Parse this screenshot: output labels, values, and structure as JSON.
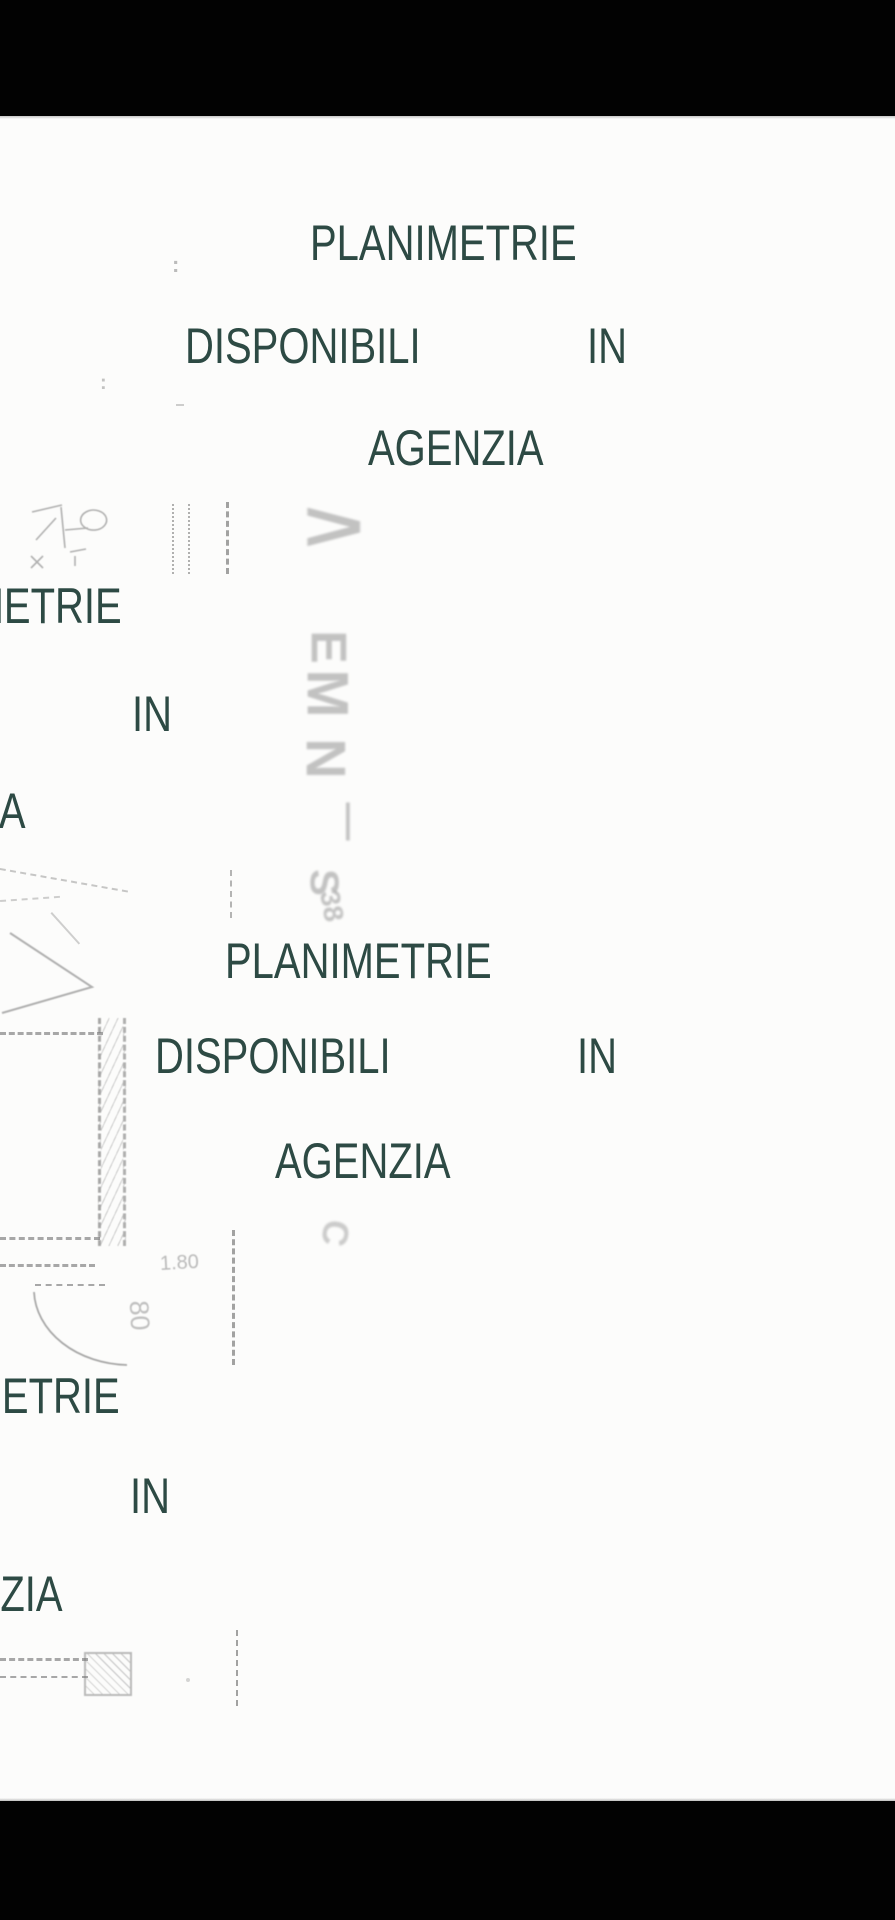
{
  "page": {
    "background": "#fcfcfb",
    "letterbox_color": "#020202",
    "watermark_color": "#2d4a44"
  },
  "watermark": {
    "word_planimetrie": "PLANIMETRIE",
    "word_disponibili": "DISPONIBILI",
    "word_in": "IN",
    "word_agenzia": "AGENZIA"
  },
  "plan": {
    "dim_width": "1.80",
    "dim_door": "80",
    "stamp_glyphs": [
      "E",
      "M",
      "N",
      "—",
      "S",
      "38"
    ],
    "arrow_glyph": ">",
    "c_glyph": "C",
    "colon_glyph": ":"
  }
}
